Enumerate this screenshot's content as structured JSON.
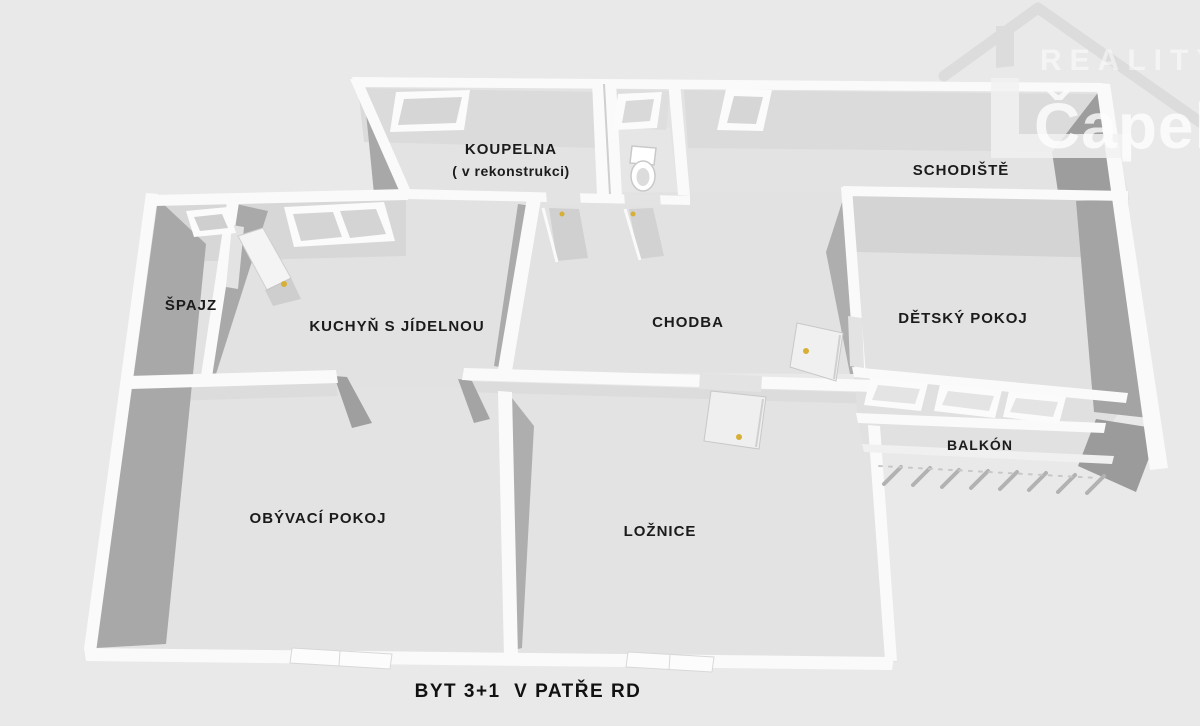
{
  "plan": {
    "caption": "BYT 3+1  V PATŘE RD",
    "rooms": [
      {
        "id": "koupelna",
        "label": "KOUPELNA",
        "note": "( v rekonstrukci)"
      },
      {
        "id": "schodiste",
        "label": "SCHODIŠTĚ"
      },
      {
        "id": "spajz",
        "label": "ŠPAJZ"
      },
      {
        "id": "kuchyn",
        "label": "KUCHYŇ S JÍDELNOU"
      },
      {
        "id": "chodba",
        "label": "CHODBA"
      },
      {
        "id": "detsky-pokoj",
        "label": "DĚTSKÝ POKOJ"
      },
      {
        "id": "obyvaci-pokoj",
        "label": "OBÝVACÍ POKOJ"
      },
      {
        "id": "loznice",
        "label": "LOŽNICE"
      },
      {
        "id": "balkon",
        "label": "BALKÓN"
      }
    ]
  },
  "watermark": {
    "top": "REALITY",
    "bottom": "Čapek"
  },
  "colors": {
    "background": "#e9e9e9",
    "floor": "#e3e3e3",
    "wall": "#fafafa",
    "wall_face_light": "#d7d7d7",
    "wall_face_dark": "#a6a6a6",
    "door_knob_yellow": "#d8af35",
    "label_text": "#1b1b1b",
    "watermark_white": "#ffffff"
  }
}
